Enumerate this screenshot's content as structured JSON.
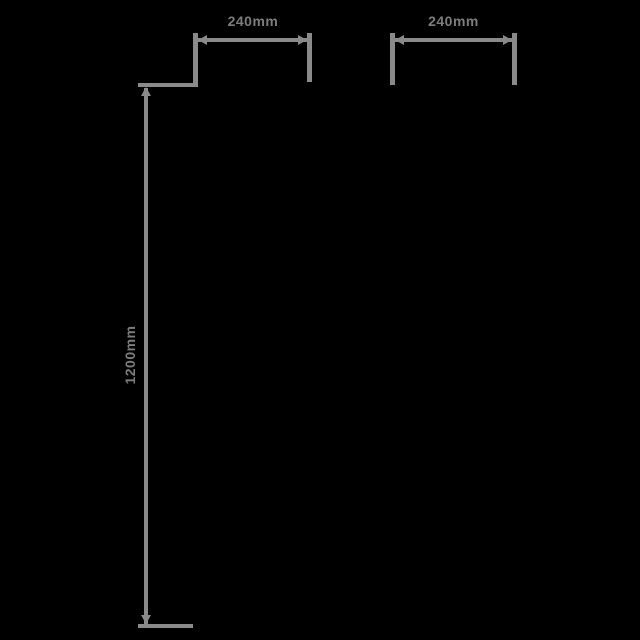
{
  "diagram": {
    "type": "product-dimension-drawing",
    "background_color": "#000000",
    "line_color": "#8a8a8a",
    "text_color": "#7d7d7d",
    "dimensions": [
      {
        "id": "top-left-width",
        "label": "240mm",
        "orientation": "horizontal"
      },
      {
        "id": "top-right-width",
        "label": "240mm",
        "orientation": "horizontal"
      },
      {
        "id": "height",
        "label": "1200mm",
        "orientation": "vertical"
      }
    ]
  }
}
